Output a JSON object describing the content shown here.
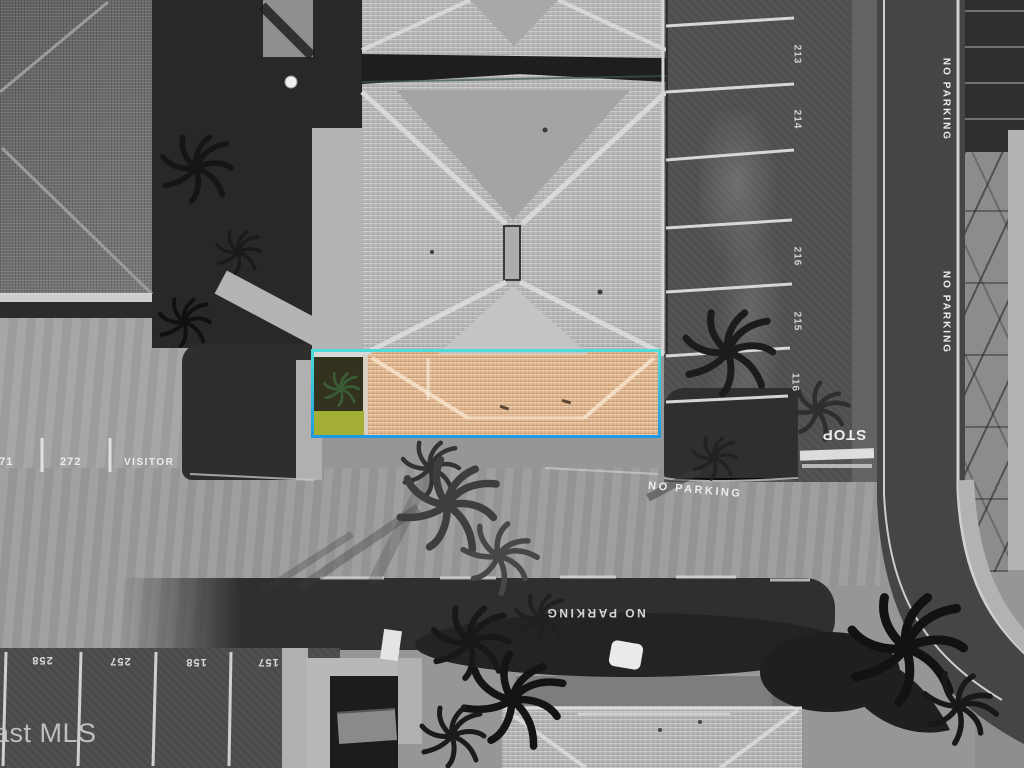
{
  "watermark": {
    "text": "ast MLS"
  },
  "road_markings": {
    "no_parking_center": "NO PARKING",
    "no_parking_lower": "NO PARKING",
    "no_parking_right_upper": "NO PARKING",
    "no_parking_right_lower": "NO PARKING",
    "stop": "STOP"
  },
  "parking": {
    "left_row": {
      "labels": [
        "271",
        "272",
        "VISITOR"
      ]
    },
    "right_column": {
      "labels": [
        "213",
        "214",
        "216",
        "215",
        "116"
      ]
    },
    "bottom_row": {
      "labels": [
        "258",
        "257",
        "158",
        "157"
      ]
    }
  },
  "colors": {
    "hl-border-top": "#4fdcd6",
    "hl-border-bottom": "#1f99e2",
    "roof-tan": "#e3bc95",
    "grass-green": "#a3af34",
    "palm-green": "#3a5c33"
  }
}
